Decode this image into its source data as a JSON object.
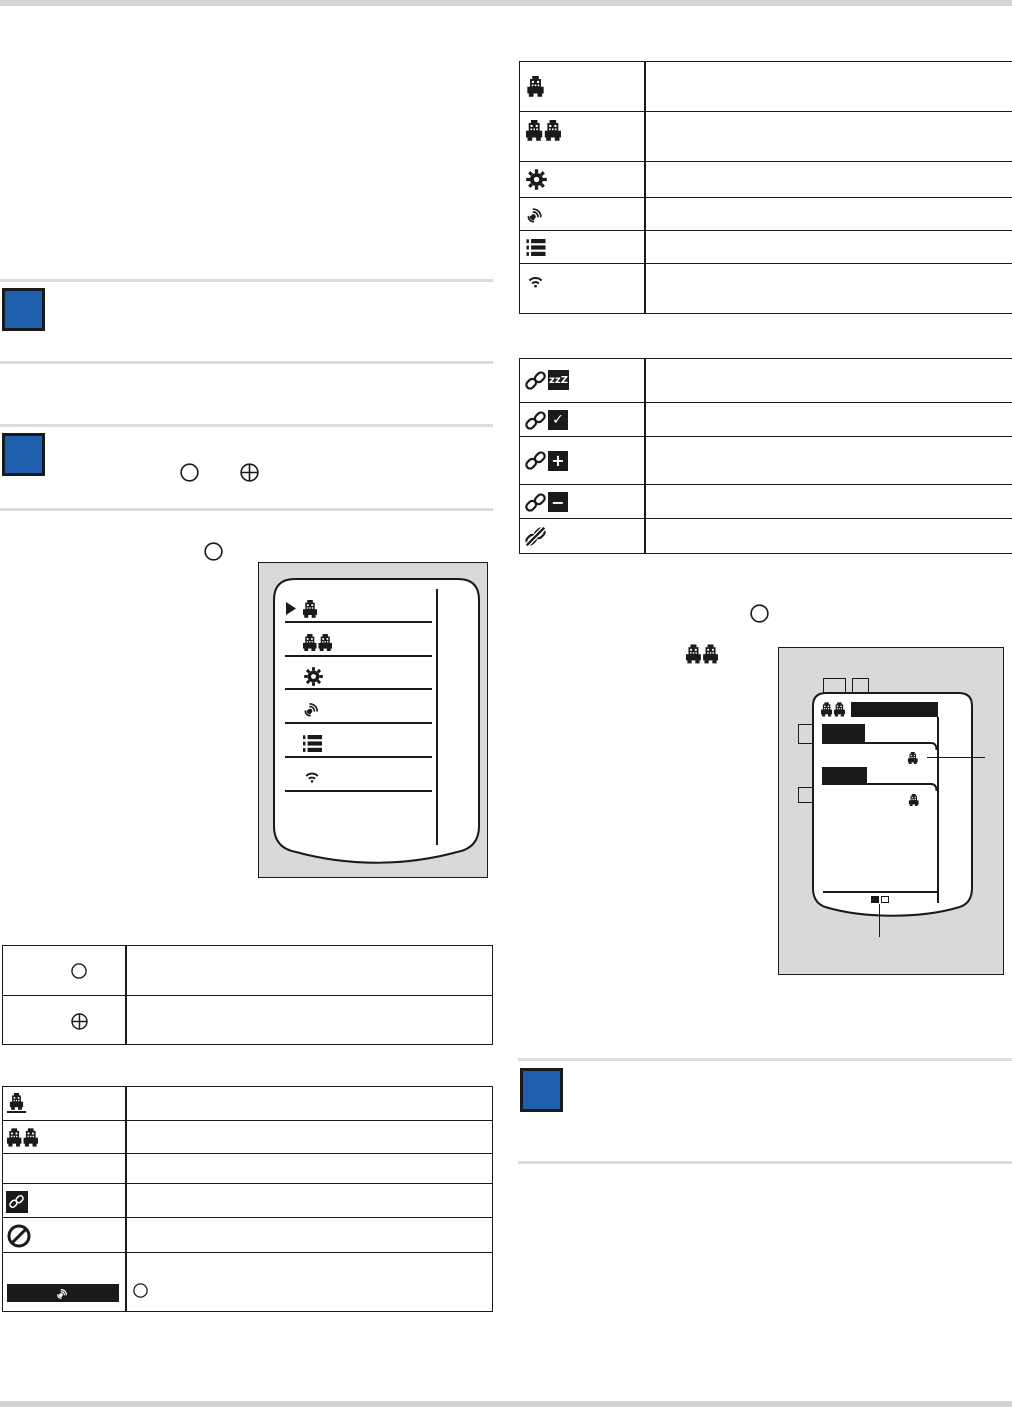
{
  "page": {
    "width": 1012,
    "height": 1407,
    "background": "#ffffff",
    "edge_bar_color": "#d4d4d4"
  },
  "palette": {
    "accent_blue": "#1e5fae",
    "ink": "#1a1a1a",
    "panel_gray": "#d9d9d9",
    "rule_gray": "#dcdcdc"
  },
  "notes": {
    "count": 3,
    "color": "#1e5fae",
    "positions": [
      "left-note-1",
      "left-note-2",
      "right-note-1"
    ]
  },
  "inline_symbols": {
    "left_note2": [
      "circle-button",
      "circled-plus-button"
    ],
    "left_menu_intro": [
      "circle-button"
    ],
    "right_intro": [
      "circle-button",
      "car-pair-icon"
    ]
  },
  "icon_tables": {
    "menu_icons": {
      "rows": [
        {
          "icon": "car"
        },
        {
          "icon": "car-pair"
        },
        {
          "icon": "gear"
        },
        {
          "icon": "remote-pairing"
        },
        {
          "icon": "list"
        },
        {
          "icon": "wifi"
        }
      ]
    },
    "link_status": {
      "rows": [
        {
          "icon": "link",
          "badge": "zzZ"
        },
        {
          "icon": "link",
          "badge": "✓"
        },
        {
          "icon": "link",
          "badge": "+"
        },
        {
          "icon": "link",
          "badge": "−"
        },
        {
          "icon": "link-off",
          "badge": ""
        }
      ]
    },
    "buttons": {
      "rows": [
        {
          "icon": "circle-button"
        },
        {
          "icon": "circled-plus-button"
        }
      ]
    },
    "status_legend": {
      "rows": [
        {
          "icon": "car-underline"
        },
        {
          "icon": "car-pair"
        },
        {
          "icon": ""
        },
        {
          "icon": "link-inverse-badge"
        },
        {
          "icon": "prohibited"
        },
        {
          "icon": "pairing-banner",
          "col2_icon": "circle-button"
        }
      ]
    }
  },
  "figures": {
    "menu_screen": {
      "items": [
        "car",
        "car-pair",
        "gear",
        "remote-pairing",
        "list",
        "wifi"
      ],
      "cursor_index": 0
    },
    "pairing_screen": {
      "header_icon": "car-pair",
      "entries": 2,
      "entry_icon": "car",
      "page_indicator": [
        "filled-square",
        "empty-square"
      ],
      "callouts": [
        "entry-car-callout",
        "page-indicator-callout"
      ]
    }
  }
}
